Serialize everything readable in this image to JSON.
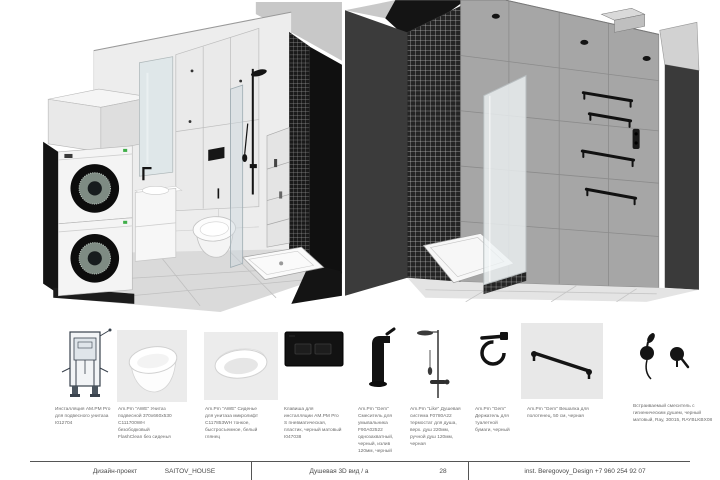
{
  "document": {
    "type_label": "Дизайн-проект",
    "project_name": "SAITOV_HOUSE",
    "sheet_title": "Душевая 3D вид / а",
    "sheet_number": "28",
    "contact": "inst. Beregovoy_Design  +7 960 254 92 07"
  },
  "views": {
    "left": {
      "name": "bathroom-3d-axonometry-left"
    },
    "right": {
      "name": "shower-3d-axonometry-right"
    }
  },
  "products": [
    {
      "icon": "installation-frame-thumbnail",
      "caption": "Инсталляция AM.PM Pro для подвесного унитаза I012704"
    },
    {
      "icon": "wall-hung-toilet-thumbnail",
      "caption": "Am.Pm \"AWE\" Унитаз подвесной 370х660х530 C111700WH безободковый FlashClean без сиденья"
    },
    {
      "icon": "toilet-seat-thumbnail",
      "caption": "Am.Pm \"AWE\" Сиденье для унитаза микролифт C117853WH тонкое, быстросъемное, белый глянец"
    },
    {
      "icon": "flush-plate-thumbnail",
      "caption": "Клавиша для инсталляции AM.PM Pro S пневматическая, пластик, черный матовый I047038"
    },
    {
      "icon": "basin-faucet-thumbnail",
      "caption": "Am.Pm \"Gem\" Смеситель для умывальника F90A02522 однозахватный, черный, излив 120мм, черный"
    },
    {
      "icon": "shower-system-thumbnail",
      "caption": "Am.Pm \"Like\" Душевая система F0780A22 термостат для душа, верх. душ 220мм, ручной душ 120мм, черная"
    },
    {
      "icon": "paper-holder-thumbnail",
      "caption": "Am.Pm \"Gem\" Держатель для туалетной бумаги, черный"
    },
    {
      "icon": "towel-bar-thumbnail",
      "caption": "Am.Pm \"Gem\" Вешалка для полотенец, 50 см, черная"
    },
    {
      "icon": "hygienic-shower-thumbnail",
      "caption": "Встраиваемый смеситель с гигиеническим душем, черный матовый, Ray, 30015, RAYBLKBX08"
    }
  ],
  "colors": {
    "accent_black": "#141414",
    "charcoal_wall": "#3b3b3b",
    "tile_gray": "#a6a6a6",
    "light_wall": "#ededed",
    "photo_bg": "#ebebeb",
    "caption_text": "#6b6b6b"
  }
}
